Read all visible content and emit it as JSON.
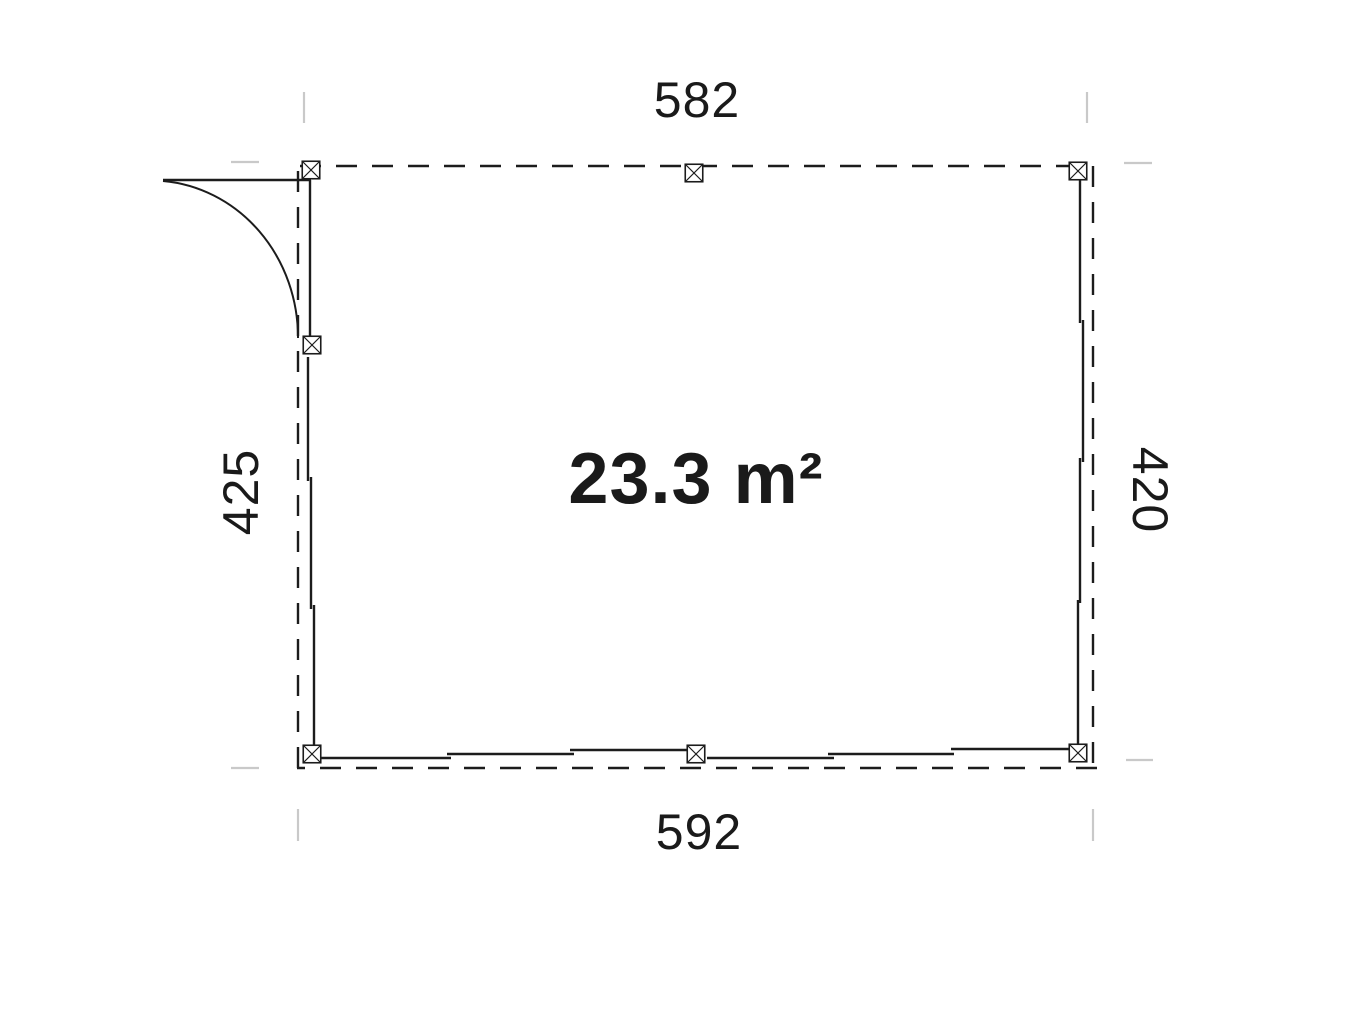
{
  "plan": {
    "area_label": "23.3 m²",
    "dim_top": "582",
    "dim_bottom": "592",
    "dim_left": "425",
    "dim_right": "420",
    "colors": {
      "line": "#1c1c1c",
      "tick": "#c9c9c9",
      "post_fill": "#ffffff",
      "text": "#1a1a1a",
      "background": "#ffffff"
    }
  }
}
